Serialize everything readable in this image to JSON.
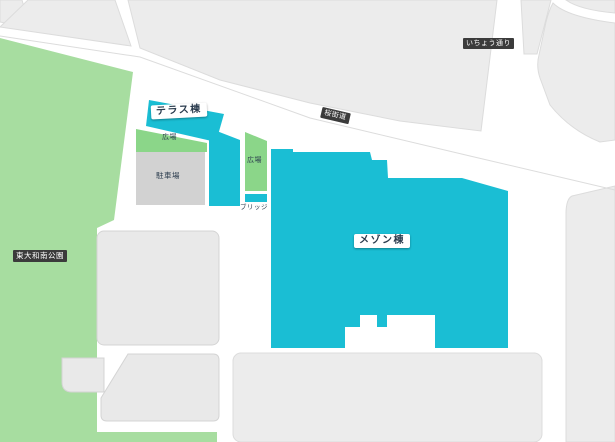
{
  "map": {
    "labels": {
      "park": "東大和南公園",
      "terrace_building": "テラス棟",
      "maison_building": "メゾン棟",
      "plaza1": "広場",
      "plaza2": "広場",
      "parking": "駐車場",
      "bridge": "ブリッジ",
      "road_sakura": "桜街道",
      "road_icho": "いちょう通り"
    },
    "colors": {
      "building_accent": "#1abed4",
      "park_green": "#a7dda0",
      "plaza_green": "#8bd689",
      "parking_gray": "#d2d2d2",
      "block_gray": "#ececec",
      "block_stroke": "#dcdcdc",
      "building_gray": "#e9e9e9",
      "building_stroke": "#d4d4d4",
      "label_dark": "#3b3b3b",
      "label_text_navy": "#2a3b4d"
    }
  }
}
